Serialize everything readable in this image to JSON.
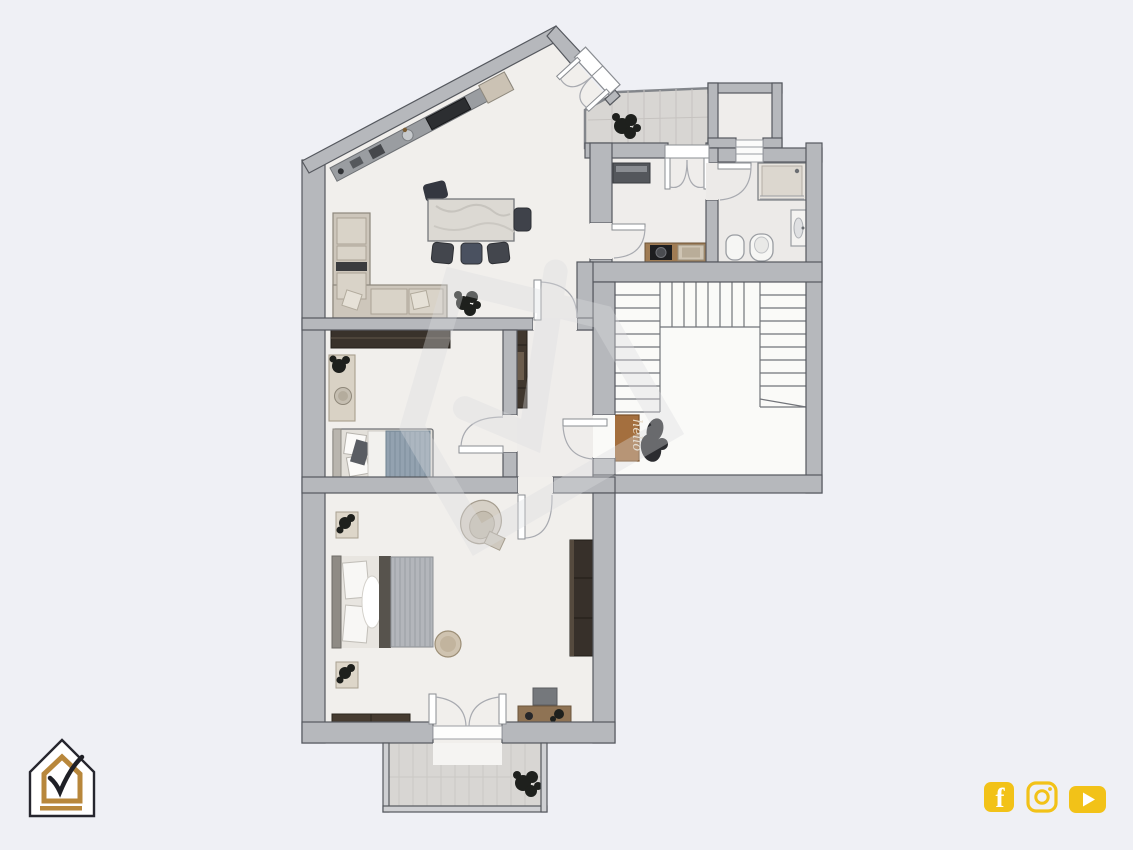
{
  "page": {
    "background": "#eff0f5"
  },
  "branding": {
    "logo_icon": "house-check-logo-icon",
    "logo_colors": {
      "outline": "#26262e",
      "inner_house": "#b8873b",
      "check": "#1f2026",
      "fill": "#ffffff",
      "underline": "#b8873b"
    }
  },
  "watermark": {
    "icon": "house-check-watermark-icon",
    "color": "#dcdde0"
  },
  "floor_plan": {
    "entry_mat_text": "hello",
    "colors": {
      "wall": "#b6b8bc",
      "wall_outline": "#55585e",
      "floor": "#f1efec",
      "stairwell_floor": "#fafaf8",
      "outdoor_tile": "#d8d6d3",
      "tile_seam": "#c6c3c0",
      "dark_wood": "#39322b",
      "mid_wood": "#8f7354",
      "counter_wood": "#a07c54",
      "sofa_beige": "#cdc6bb",
      "blanket_blue": "#93a2b0",
      "blanket_gray": "#b3b6bb",
      "mat_brown": "#a46f3e",
      "mat_text": "#e8dcc9",
      "plant_dark": "#1e201d",
      "appliance_dark": "#2c2e31",
      "chair_dark": "#43464d"
    }
  },
  "social": {
    "color": "#F2C218",
    "icons": [
      {
        "name": "facebook-icon",
        "glyph": "f"
      },
      {
        "name": "instagram-icon"
      },
      {
        "name": "youtube-icon"
      }
    ]
  }
}
